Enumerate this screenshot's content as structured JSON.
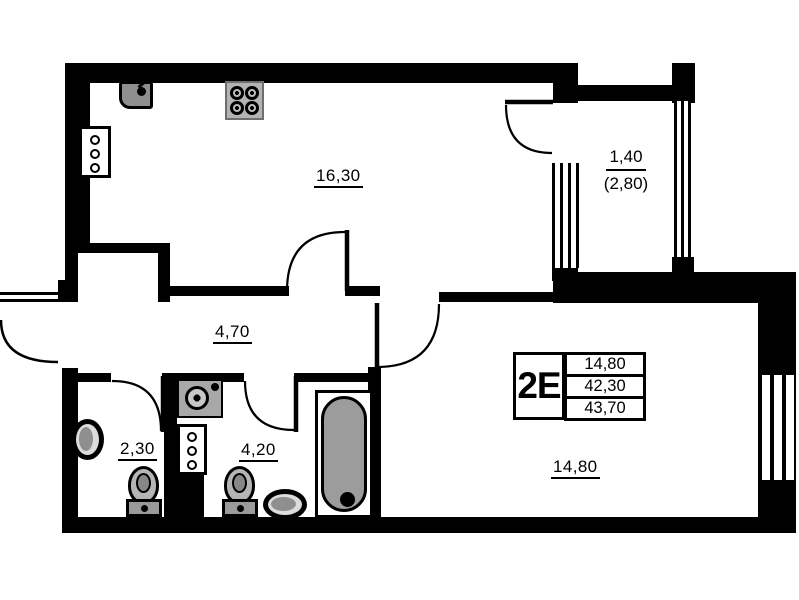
{
  "plan": {
    "title": "2E apartment floor plan",
    "rooms": {
      "kitchen": {
        "area": "16,30"
      },
      "hallway": {
        "area": "4,70"
      },
      "bathroom_small": {
        "area": "2,30"
      },
      "bathroom": {
        "area": "4,20"
      },
      "living_room": {
        "area": "14,80"
      },
      "balcony": {
        "area": "1,40",
        "area_total": "(2,80)"
      }
    },
    "legend": {
      "type": "2E",
      "rows": [
        "14,80",
        "42,30",
        "43,70"
      ]
    },
    "fixtures": [
      "kitchen-sink",
      "stove",
      "meter-panel-kitchen",
      "meter-panel-shaft",
      "washing-machine",
      "toilet-small-bath",
      "toilet-bath",
      "wall-basin-small-bath",
      "basin-bath",
      "bathtub"
    ],
    "colors": {
      "wall": "#000000",
      "fixture_fill": "#9c9c9c",
      "background": "#ffffff"
    }
  }
}
